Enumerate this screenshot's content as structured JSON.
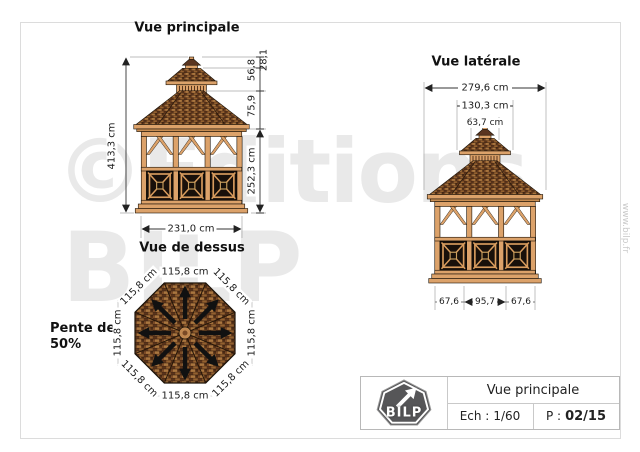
{
  "watermark": {
    "line1": "©Editions",
    "line2": "BILP",
    "website": "www.bilp.fr"
  },
  "views": {
    "main": {
      "title": "Vue principale",
      "dims": {
        "total_height": "413,3 cm",
        "finial": "28,1",
        "cupola": "56,8",
        "roof": "75,9",
        "wall": "252,3 cm",
        "width": "231,0 cm"
      }
    },
    "side": {
      "title": "Vue latérale",
      "dims": {
        "overall": "279,6 cm",
        "cupola": "130,3 cm",
        "finial": "63,7 cm",
        "base_left": "67,6",
        "base_mid": "95,7",
        "base_right": "67,6"
      }
    },
    "top": {
      "title": "Vue de dessus",
      "slope1": "Pente de",
      "slope2": "50%",
      "edge": "115,8 cm"
    }
  },
  "title_block": {
    "logo": "BILP",
    "view_name": "Vue principale",
    "scale_label": "Ech :",
    "scale_value": "1/60",
    "page_label": "P :",
    "page_value": "02/15"
  },
  "colors": {
    "wood": "#dca26a",
    "roof_dark": "#5a3520",
    "panel_dark": "#18100a",
    "watermark": "#e9e9e9",
    "logo_badge": "#565658"
  }
}
